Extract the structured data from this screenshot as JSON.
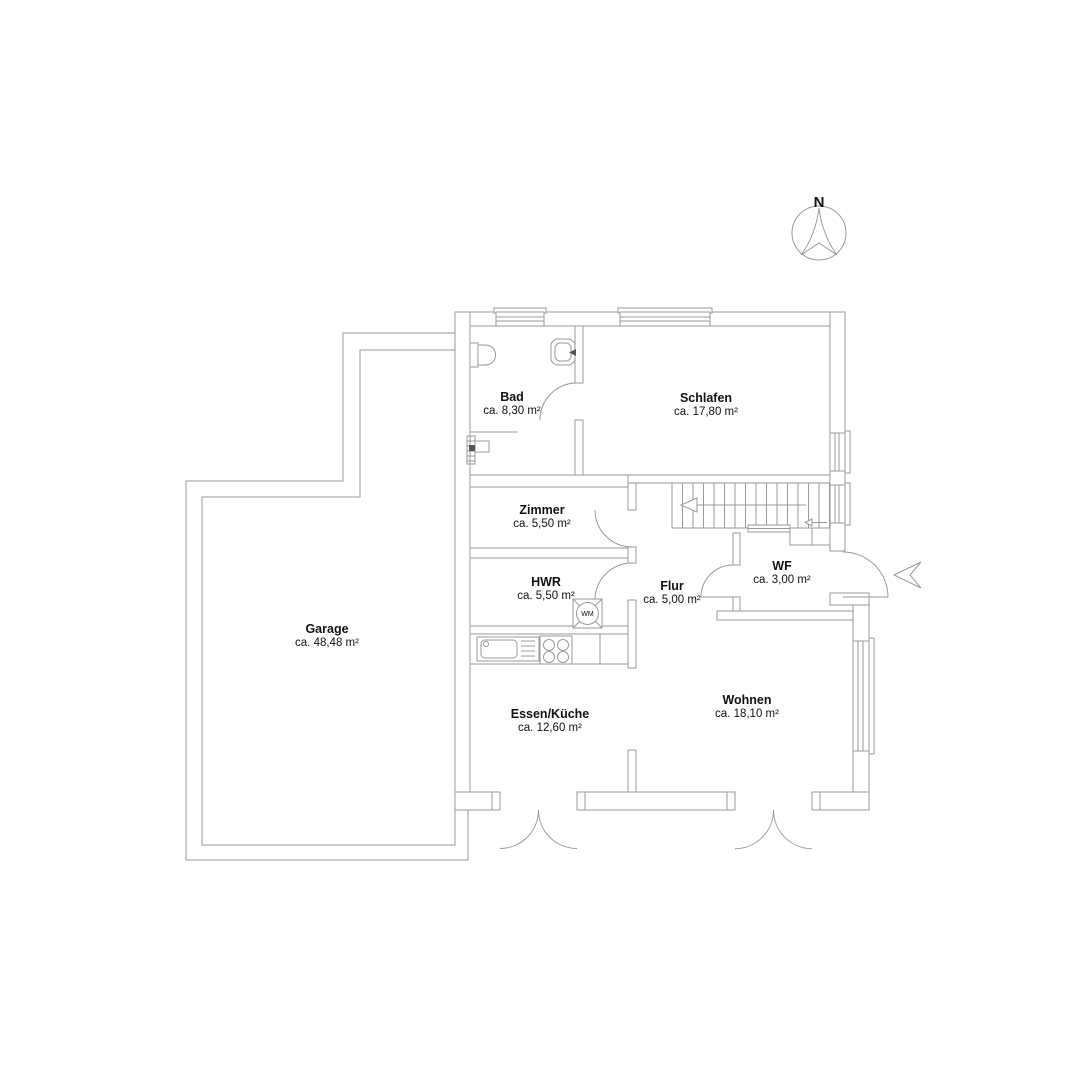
{
  "compass": {
    "label": "N"
  },
  "appliances": {
    "washing_machine_label": "WM"
  },
  "rooms": [
    {
      "id": "bad",
      "name": "Bad",
      "area": "ca. 8,30 m²"
    },
    {
      "id": "schlafen",
      "name": "Schlafen",
      "area": "ca. 17,80 m²"
    },
    {
      "id": "zimmer",
      "name": "Zimmer",
      "area": "ca. 5,50 m²"
    },
    {
      "id": "hwr",
      "name": "HWR",
      "area": "ca. 5,50 m²"
    },
    {
      "id": "flur",
      "name": "Flur",
      "area": "ca. 5,00 m²"
    },
    {
      "id": "wf",
      "name": "WF",
      "area": "ca. 3,00 m²"
    },
    {
      "id": "garage",
      "name": "Garage",
      "area": "ca. 48,48 m²"
    },
    {
      "id": "essen_kueche",
      "name": "Essen/Küche",
      "area": "ca. 12,60 m²"
    },
    {
      "id": "wohnen",
      "name": "Wohnen",
      "area": "ca. 18,10 m²"
    }
  ],
  "colors": {
    "wall_line": "#9a9a9a",
    "text": "#111111",
    "background": "#ffffff"
  }
}
